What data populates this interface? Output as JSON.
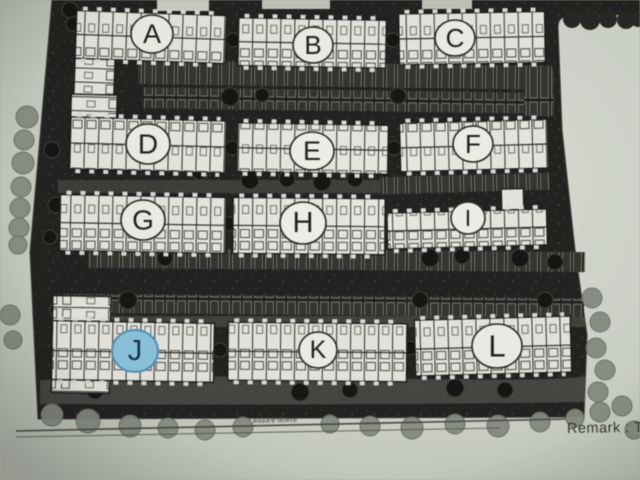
{
  "plan": {
    "buildings": [
      {
        "label": "A",
        "highlighted": false
      },
      {
        "label": "B",
        "highlighted": false
      },
      {
        "label": "C",
        "highlighted": false
      },
      {
        "label": "D",
        "highlighted": false
      },
      {
        "label": "E",
        "highlighted": false
      },
      {
        "label": "F",
        "highlighted": false
      },
      {
        "label": "G",
        "highlighted": false
      },
      {
        "label": "H",
        "highlighted": false
      },
      {
        "label": "I",
        "highlighted": false
      },
      {
        "label": "J",
        "highlighted": true
      },
      {
        "label": "K",
        "highlighted": false
      },
      {
        "label": "L",
        "highlighted": false
      }
    ],
    "caption": "คลองเช่าที่เพรย",
    "highlight_color": "#8cc6e0"
  },
  "footer": {
    "remark": "Remark : T"
  },
  "colors": {
    "paper": "#d3d8cd",
    "ink": "#212120",
    "highlight": "#8cc6e0",
    "highlight_letter": "#14364d"
  }
}
